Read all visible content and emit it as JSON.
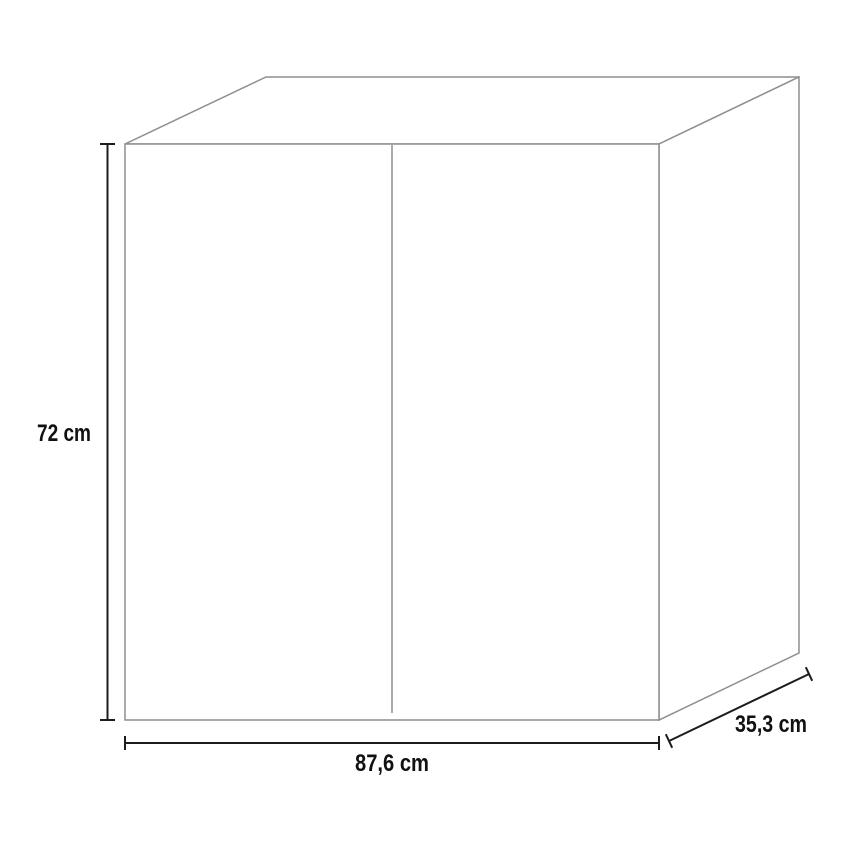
{
  "diagram": {
    "figure": "two-door-cabinet-dimension-drawing",
    "dimensions": {
      "height": {
        "label": "72 cm"
      },
      "width": {
        "label": "87,6 cm"
      },
      "depth": {
        "label": "35,3 cm"
      }
    },
    "colors": {
      "outline": "#8e8e8e",
      "dimension": "#1c1c1c",
      "text": "#111111",
      "background": "#ffffff"
    }
  }
}
